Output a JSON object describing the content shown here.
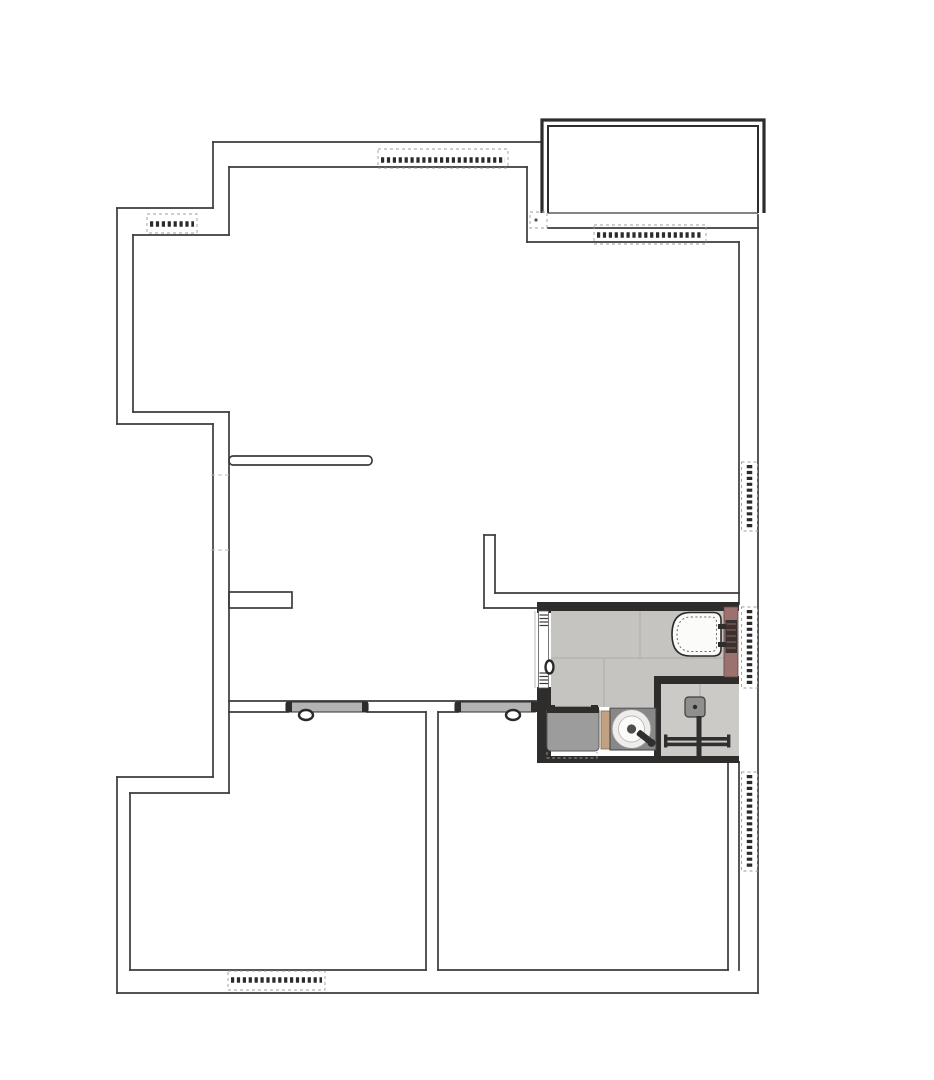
{
  "document": {
    "kind": "apartment floor plan drawing",
    "visible_text": ""
  },
  "colors": {
    "background": "#ffffff",
    "wall_line": "#3b3b3b",
    "wall_dark": "#2e2d2c",
    "accent_wall": "#9c7270",
    "accent_wall_edge": "#5f4341",
    "bathroom_tile": "#c6c4c1",
    "tile_grout": "#aeaca9",
    "shower_floor": "#cccac7",
    "washer_gray": "#9c9c9c",
    "counter_gray": "#88888a",
    "wood_cabinet": "#c2a181",
    "door_panel_gray": "#b3b3b3",
    "fixture_white": "#fbfbfa",
    "flush_plate_dark": "#3a3230",
    "window_symbol": "#2b2b2b",
    "shower_fixture": "#8f8f8d",
    "fixture_metal": "#2f2f2f"
  },
  "legend": {
    "areas": [
      "balcony",
      "living-area",
      "hallway",
      "bottom-left-room",
      "bottom-right-room",
      "bathroom",
      "shower-enclosure"
    ],
    "fixtures": [
      "wall-hung-toilet",
      "round-washbasin",
      "washing-machine",
      "vanity-wood-panel",
      "shower-head-set",
      "towel-bar"
    ],
    "openings": [
      "window-symbol x7",
      "sliding-door x3",
      "open-passage"
    ]
  }
}
